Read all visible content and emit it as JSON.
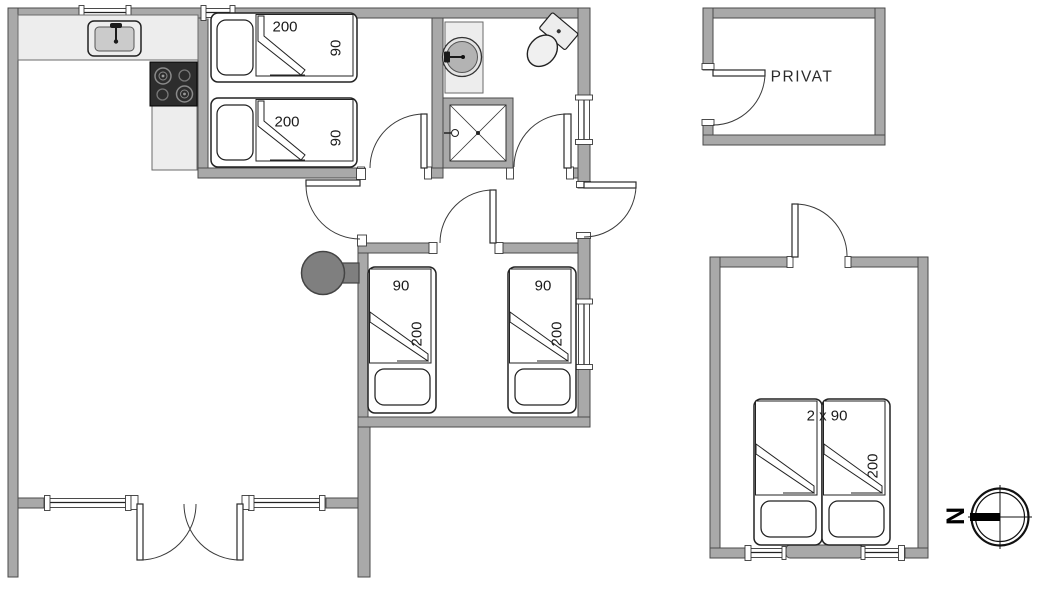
{
  "plan": {
    "type": "holiday-house-floor-plan",
    "labels": {
      "privat": "PRIVAT",
      "compass_north": "N"
    },
    "beds": {
      "bedroom1_bed1": {
        "length": "200",
        "width": "90"
      },
      "bedroom1_bed2": {
        "length": "200",
        "width": "90"
      },
      "bedroom2_bed1": {
        "width": "90",
        "length": "200"
      },
      "bedroom2_bed2": {
        "width": "90",
        "length": "200"
      },
      "annex_double_bed": {
        "size": "2 x 90",
        "length": "200"
      }
    },
    "icons": [
      "kitchen-sink",
      "cooktop",
      "washbasin",
      "toilet",
      "shower-cabin",
      "wood-stove",
      "door-swing",
      "window",
      "compass-rose"
    ],
    "colors": {
      "wall": "#a9a9a9",
      "wall_outline": "#4a4a4a",
      "fixture": "#ededed",
      "cooktop_dark": "#2d2d2d",
      "wood_stove": "#7f7f7f",
      "text": "#1a1a1a",
      "background": "#ffffff"
    }
  }
}
